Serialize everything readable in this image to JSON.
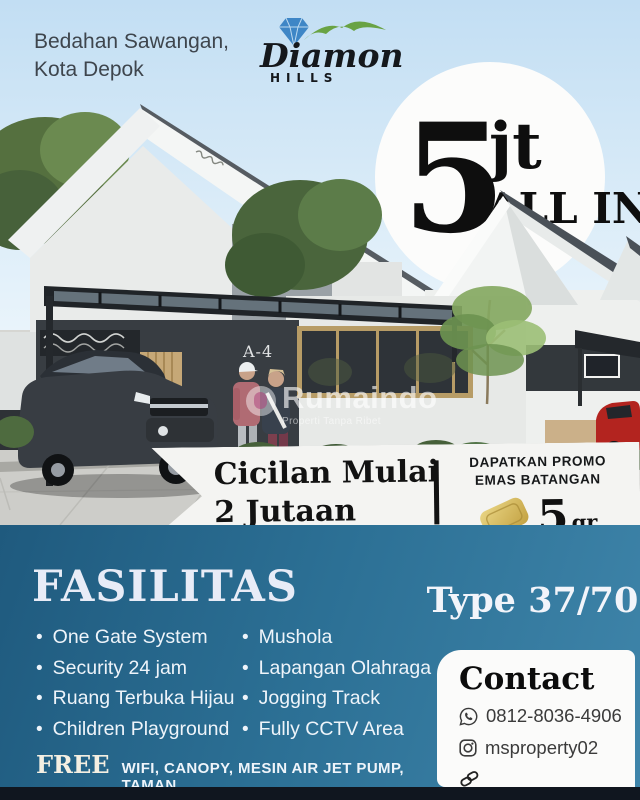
{
  "ui": {
    "bullet": "•"
  },
  "header": {
    "location_line1": "Bedahan Sawangan,",
    "location_line2": "Kota Depok",
    "logo": {
      "brand": "Diamond",
      "sub_brand": "HILLS"
    }
  },
  "price_badge": {
    "amount": "5",
    "unit": "jt",
    "tagline": "ALL IN"
  },
  "photo": {
    "unit_label": "A-4",
    "watermark_name": "Rumaindo",
    "watermark_tagline": "Properti Tanpa Ribet"
  },
  "installment_banner": {
    "line1": "Cicilan Mulai",
    "line2": "2 Jutaan",
    "promo_line1": "DAPATKAN PROMO",
    "promo_line2": "EMAS BATANGAN",
    "gold_amount": "5",
    "gold_unit": "gr"
  },
  "facilities": {
    "heading": "FASILITAS",
    "column1": [
      "One Gate System",
      "Security 24 jam",
      "Ruang Terbuka Hijau",
      "Children Playground"
    ],
    "column2": [
      "Mushola",
      "Lapangan Olahraga",
      "Jogging Track",
      "Fully CCTV Area"
    ],
    "free_label": "FREE",
    "free_items": "WIFI, CANOPY, MESIN AIR JET PUMP, TAMAN"
  },
  "unit_type": {
    "label": "Type 37/70"
  },
  "contact": {
    "heading": "Contact",
    "phone": "0812-8036-4906",
    "instagram": "msproperty02"
  },
  "colors": {
    "teal_start": "#1f5a7e",
    "teal_end": "#3f85aa",
    "gold": "#d9bd5f",
    "strip": "#10161f",
    "sky": "#c5e0f4"
  }
}
